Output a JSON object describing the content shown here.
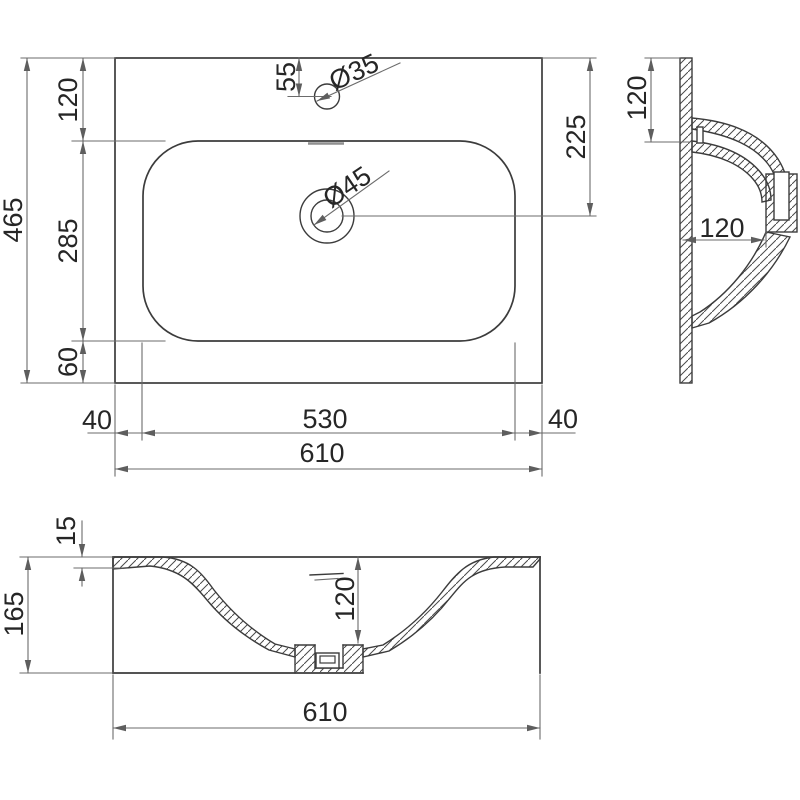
{
  "meta": {
    "drawing_type": "washbasin technical drawing",
    "background": "#ffffff",
    "line_color": "#3c3c3c",
    "dimension_color": "#6b6b6b",
    "hatch_color": "#4a4a4a",
    "text_color": "#262626"
  },
  "views": {
    "top": {
      "dims": {
        "overall_depth": "465",
        "rear_offset": "120",
        "basin_depth": "285",
        "front_offset": "60",
        "faucet_setback": "55",
        "faucet_hole_dia": "Ø35",
        "drain_hole_dia": "Ø45",
        "drain_setback": "225",
        "left_margin": "40",
        "basin_width": "530",
        "right_margin": "40",
        "overall_width": "610"
      }
    },
    "side": {
      "dims": {
        "rim_depth": "120",
        "bowl_depth": "120"
      }
    },
    "front": {
      "dims": {
        "rim_thickness": "15",
        "overall_height": "165",
        "bowl_depth": "120",
        "overall_width": "610"
      }
    }
  }
}
